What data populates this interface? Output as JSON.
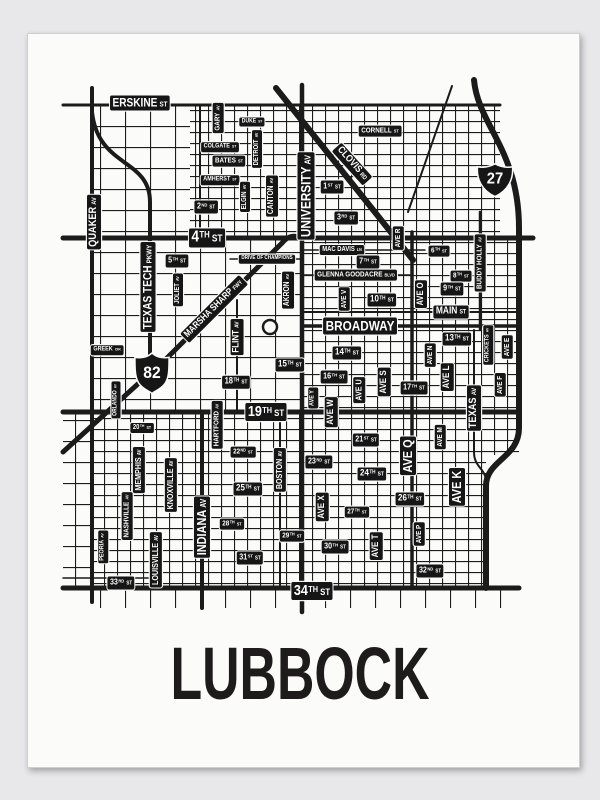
{
  "poster": {
    "title": "LUBBOCK"
  },
  "colors": {
    "ink": "#161616",
    "paper": "#fbfbfa",
    "background": "#e8e8ea"
  },
  "shields": [
    {
      "route": "82",
      "type": "us-route"
    },
    {
      "route": "27",
      "type": "interstate"
    }
  ],
  "labels": [
    {
      "m": "ERSKINE",
      "s": "ST",
      "x": 140,
      "y": 103,
      "f": 12
    },
    {
      "m": "DUKE",
      "s": "ST",
      "x": 252,
      "y": 122,
      "f": 6
    },
    {
      "m": "COLGATE",
      "s": "ST",
      "x": 220,
      "y": 147,
      "f": 6.5
    },
    {
      "m": "BATES",
      "s": "ST",
      "x": 229,
      "y": 161,
      "f": 7.5
    },
    {
      "m": "AMHERST",
      "s": "ST",
      "x": 220,
      "y": 180,
      "f": 6.5
    },
    {
      "m": "2",
      "o": "ND",
      "s": "ST",
      "x": 206,
      "y": 207,
      "f": 8.5
    },
    {
      "m": "4",
      "o": "TH",
      "s": "ST",
      "x": 207,
      "y": 238,
      "f": 16
    },
    {
      "m": "5",
      "o": "TH",
      "s": "ST",
      "x": 177,
      "y": 261,
      "f": 8.5
    },
    {
      "m": "CORNELL",
      "s": "ST",
      "x": 380,
      "y": 131,
      "f": 7.5
    },
    {
      "m": "1",
      "o": "ST",
      "s": "ST",
      "x": 332,
      "y": 187,
      "f": 8.5
    },
    {
      "m": "3",
      "o": "RD",
      "s": "ST",
      "x": 346,
      "y": 218,
      "f": 8.5
    },
    {
      "m": "MAC DAVIS",
      "s": "LN",
      "x": 342,
      "y": 250,
      "f": 7
    },
    {
      "m": "6",
      "o": "TH",
      "s": "ST",
      "x": 439,
      "y": 251,
      "f": 7.5
    },
    {
      "m": "7",
      "o": "TH",
      "s": "ST",
      "x": 368,
      "y": 262,
      "f": 8.5
    },
    {
      "m": "DRIVE OF CHAMPIONS",
      "x": 267,
      "y": 259,
      "f": 5.5
    },
    {
      "m": "GLENNA GOODACRE",
      "s": "BLVD",
      "x": 356,
      "y": 275,
      "f": 7.5
    },
    {
      "m": "8",
      "o": "TH",
      "s": "ST",
      "x": 461,
      "y": 276,
      "f": 7.5
    },
    {
      "m": "9",
      "o": "TH",
      "s": "ST",
      "x": 452,
      "y": 289,
      "f": 8.5
    },
    {
      "m": "10",
      "o": "TH",
      "s": "ST",
      "x": 382,
      "y": 300,
      "f": 9.5
    },
    {
      "m": "MAIN",
      "s": "ST",
      "x": 451,
      "y": 312,
      "f": 10
    },
    {
      "m": "BROADWAY",
      "x": 360,
      "y": 326,
      "f": 14
    },
    {
      "m": "13",
      "o": "TH",
      "s": "ST",
      "x": 457,
      "y": 339,
      "f": 9.5
    },
    {
      "m": "14",
      "o": "TH",
      "s": "ST",
      "x": 347,
      "y": 353,
      "f": 9.5
    },
    {
      "m": "15",
      "o": "TH",
      "s": "ST",
      "x": 290,
      "y": 365,
      "f": 9.5
    },
    {
      "m": "16",
      "o": "TH",
      "s": "ST",
      "x": 334,
      "y": 377,
      "f": 8.5
    },
    {
      "m": "17",
      "o": "TH",
      "s": "ST",
      "x": 414,
      "y": 388,
      "f": 8.5
    },
    {
      "m": "18",
      "o": "TH",
      "s": "ST",
      "x": 236,
      "y": 382,
      "f": 9
    },
    {
      "m": "19",
      "o": "TH",
      "s": "ST",
      "x": 266,
      "y": 412,
      "f": 15
    },
    {
      "m": "GREEK",
      "s": "CIR",
      "x": 107,
      "y": 350,
      "f": 6.5
    },
    {
      "m": "20",
      "o": "TH",
      "s": "ST",
      "x": 142,
      "y": 428,
      "f": 7
    },
    {
      "m": "21",
      "o": "ST",
      "s": "ST",
      "x": 366,
      "y": 440,
      "f": 8.5
    },
    {
      "m": "22",
      "o": "ND",
      "s": "ST",
      "x": 243,
      "y": 452,
      "f": 7.5
    },
    {
      "m": "23",
      "o": "RD",
      "s": "ST",
      "x": 319,
      "y": 462,
      "f": 8.5
    },
    {
      "m": "24",
      "o": "TH",
      "s": "ST",
      "x": 372,
      "y": 474,
      "f": 9.5
    },
    {
      "m": "25",
      "o": "TH",
      "s": "ST",
      "x": 248,
      "y": 489,
      "f": 9.5
    },
    {
      "m": "26",
      "o": "TH",
      "s": "ST",
      "x": 410,
      "y": 499,
      "f": 9.5
    },
    {
      "m": "27",
      "o": "TH",
      "s": "ST",
      "x": 357,
      "y": 512,
      "f": 7.5
    },
    {
      "m": "28",
      "o": "TH",
      "s": "ST",
      "x": 232,
      "y": 524,
      "f": 7.5
    },
    {
      "m": "29",
      "o": "TH",
      "s": "ST",
      "x": 292,
      "y": 536,
      "f": 7.5
    },
    {
      "m": "30",
      "o": "TH",
      "s": "ST",
      "x": 335,
      "y": 547,
      "f": 8.5
    },
    {
      "m": "31",
      "o": "ST",
      "s": "ST",
      "x": 250,
      "y": 558,
      "f": 8.5
    },
    {
      "m": "32",
      "o": "ND",
      "s": "ST",
      "x": 430,
      "y": 571,
      "f": 8.5
    },
    {
      "m": "33",
      "o": "RD",
      "s": "ST",
      "x": 121,
      "y": 583,
      "f": 8.5
    },
    {
      "m": "34",
      "o": "TH",
      "s": "ST",
      "x": 312,
      "y": 591,
      "f": 15
    },
    {
      "m": "QUAKER",
      "s": "AV",
      "x": 94,
      "y": 222,
      "r": -90,
      "f": 11
    },
    {
      "m": "GARY",
      "s": "AV",
      "x": 218,
      "y": 118,
      "r": -90,
      "f": 7.5
    },
    {
      "m": "DETROIT",
      "s": "AV",
      "x": 257,
      "y": 149,
      "r": -90,
      "f": 7
    },
    {
      "m": "ELGIN",
      "s": "AV",
      "x": 245,
      "y": 197,
      "r": -90,
      "f": 7
    },
    {
      "m": "CANTON",
      "s": "AV",
      "x": 272,
      "y": 196,
      "r": -90,
      "f": 8
    },
    {
      "m": "UNIVERSITY",
      "s": "AV",
      "x": 306,
      "y": 196,
      "r": -90,
      "f": 14
    },
    {
      "m": "TEXAS TECH",
      "s": "PKWY",
      "x": 148,
      "y": 287,
      "r": -90,
      "f": 12
    },
    {
      "m": "JOLIET",
      "s": "AV",
      "x": 178,
      "y": 290,
      "r": -90,
      "f": 7
    },
    {
      "m": "AKRON",
      "s": "AV",
      "x": 288,
      "y": 290,
      "r": -90,
      "f": 8
    },
    {
      "m": "FLINT",
      "s": "AV",
      "x": 237,
      "y": 337,
      "r": -90,
      "f": 9.5
    },
    {
      "m": "ORLANDO",
      "s": "AV",
      "x": 116,
      "y": 400,
      "r": -90,
      "f": 6
    },
    {
      "m": "HARTFORD",
      "s": "AV",
      "x": 217,
      "y": 425,
      "r": -90,
      "f": 7.5
    },
    {
      "m": "AVE V",
      "x": 344,
      "y": 299,
      "r": -90,
      "f": 7.5
    },
    {
      "m": "AVE R",
      "x": 398,
      "y": 238,
      "r": -90,
      "f": 7.5
    },
    {
      "m": "BUDDY HOLLY",
      "s": "AV",
      "x": 480,
      "y": 263,
      "r": -90,
      "f": 7.5
    },
    {
      "m": "AVE O",
      "x": 421,
      "y": 294,
      "r": -90,
      "f": 9
    },
    {
      "m": "CRICKETS",
      "s": "AV",
      "x": 488,
      "y": 345,
      "r": -90,
      "f": 6.5
    },
    {
      "m": "AVE E",
      "x": 507,
      "y": 347,
      "r": -90,
      "f": 7.5
    },
    {
      "m": "AVE N",
      "x": 430,
      "y": 355,
      "r": -90,
      "f": 7.5
    },
    {
      "m": "AVE L",
      "x": 447,
      "y": 377,
      "r": -90,
      "f": 9.5
    },
    {
      "m": "AVE F",
      "x": 500,
      "y": 385,
      "r": -90,
      "f": 7.5
    },
    {
      "m": "AVE U",
      "x": 359,
      "y": 390,
      "r": -90,
      "f": 8.5
    },
    {
      "m": "AVE S",
      "x": 384,
      "y": 382,
      "r": -90,
      "f": 9.5
    },
    {
      "m": "TEXAS",
      "s": "AV",
      "x": 474,
      "y": 408,
      "r": -90,
      "f": 11
    },
    {
      "m": "AVE Y",
      "x": 313,
      "y": 398,
      "r": -90,
      "f": 6.5
    },
    {
      "m": "AVE W",
      "x": 331,
      "y": 412,
      "r": -90,
      "f": 9.5
    },
    {
      "m": "MEMPHIS",
      "s": "AV",
      "x": 139,
      "y": 470,
      "r": -90,
      "f": 8.5
    },
    {
      "m": "KNOXVILLE",
      "s": "AV",
      "x": 171,
      "y": 485,
      "r": -90,
      "f": 8.5
    },
    {
      "m": "NASHVILLE",
      "s": "AV",
      "x": 127,
      "y": 516,
      "r": -90,
      "f": 7.5
    },
    {
      "m": "PEORIA",
      "s": "AV",
      "x": 103,
      "y": 547,
      "r": -90,
      "f": 6.5
    },
    {
      "m": "LOUISVILLE",
      "s": "AV",
      "x": 156,
      "y": 560,
      "r": -90,
      "f": 8.5
    },
    {
      "m": "INDIANA",
      "s": "AV",
      "x": 202,
      "y": 527,
      "r": -90,
      "f": 13
    },
    {
      "m": "BOSTON",
      "s": "AV",
      "x": 280,
      "y": 470,
      "r": -90,
      "f": 8.5
    },
    {
      "m": "AVE Q",
      "x": 408,
      "y": 456,
      "r": -90,
      "f": 13
    },
    {
      "m": "AVE M",
      "x": 440,
      "y": 437,
      "r": -90,
      "f": 7.5
    },
    {
      "m": "AVE K",
      "x": 457,
      "y": 487,
      "r": -90,
      "f": 13
    },
    {
      "m": "AVE X",
      "x": 322,
      "y": 507,
      "r": -90,
      "f": 9.5
    },
    {
      "m": "AVE P",
      "x": 419,
      "y": 534,
      "r": -90,
      "f": 7.5
    },
    {
      "m": "AVE T",
      "x": 376,
      "y": 546,
      "r": -90,
      "f": 9.5
    },
    {
      "m": "CLOVIS",
      "s": "RD",
      "x": 352,
      "y": 164,
      "r": 48,
      "f": 10
    },
    {
      "m": "MARSHA SHARP",
      "s": "FWY",
      "x": 214,
      "y": 309,
      "r": -45,
      "f": 9.5
    }
  ]
}
